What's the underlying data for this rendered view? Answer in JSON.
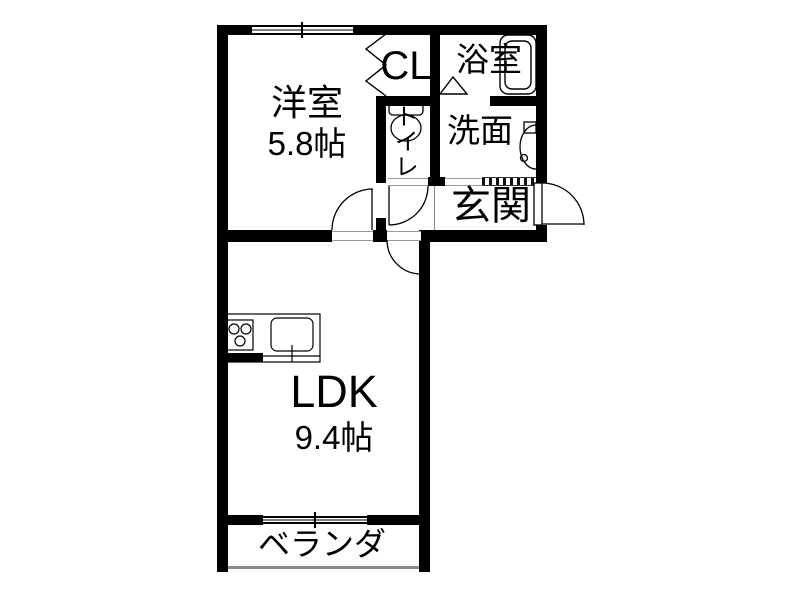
{
  "plan": {
    "rooms": {
      "western_room": {
        "label": "洋室",
        "area": "5.8帖"
      },
      "closet": {
        "label": "CL"
      },
      "bath": {
        "label": "浴室"
      },
      "toilet": {
        "label": "トイレ"
      },
      "washroom": {
        "label": "洗面"
      },
      "entrance": {
        "label": "玄関"
      },
      "ldk": {
        "label": "LDK",
        "area": "9.4帖"
      },
      "veranda": {
        "label": "ベランダ"
      }
    },
    "colors": {
      "wall": "#000000",
      "background": "#ffffff",
      "thin_line": "#8a8a8a"
    }
  }
}
